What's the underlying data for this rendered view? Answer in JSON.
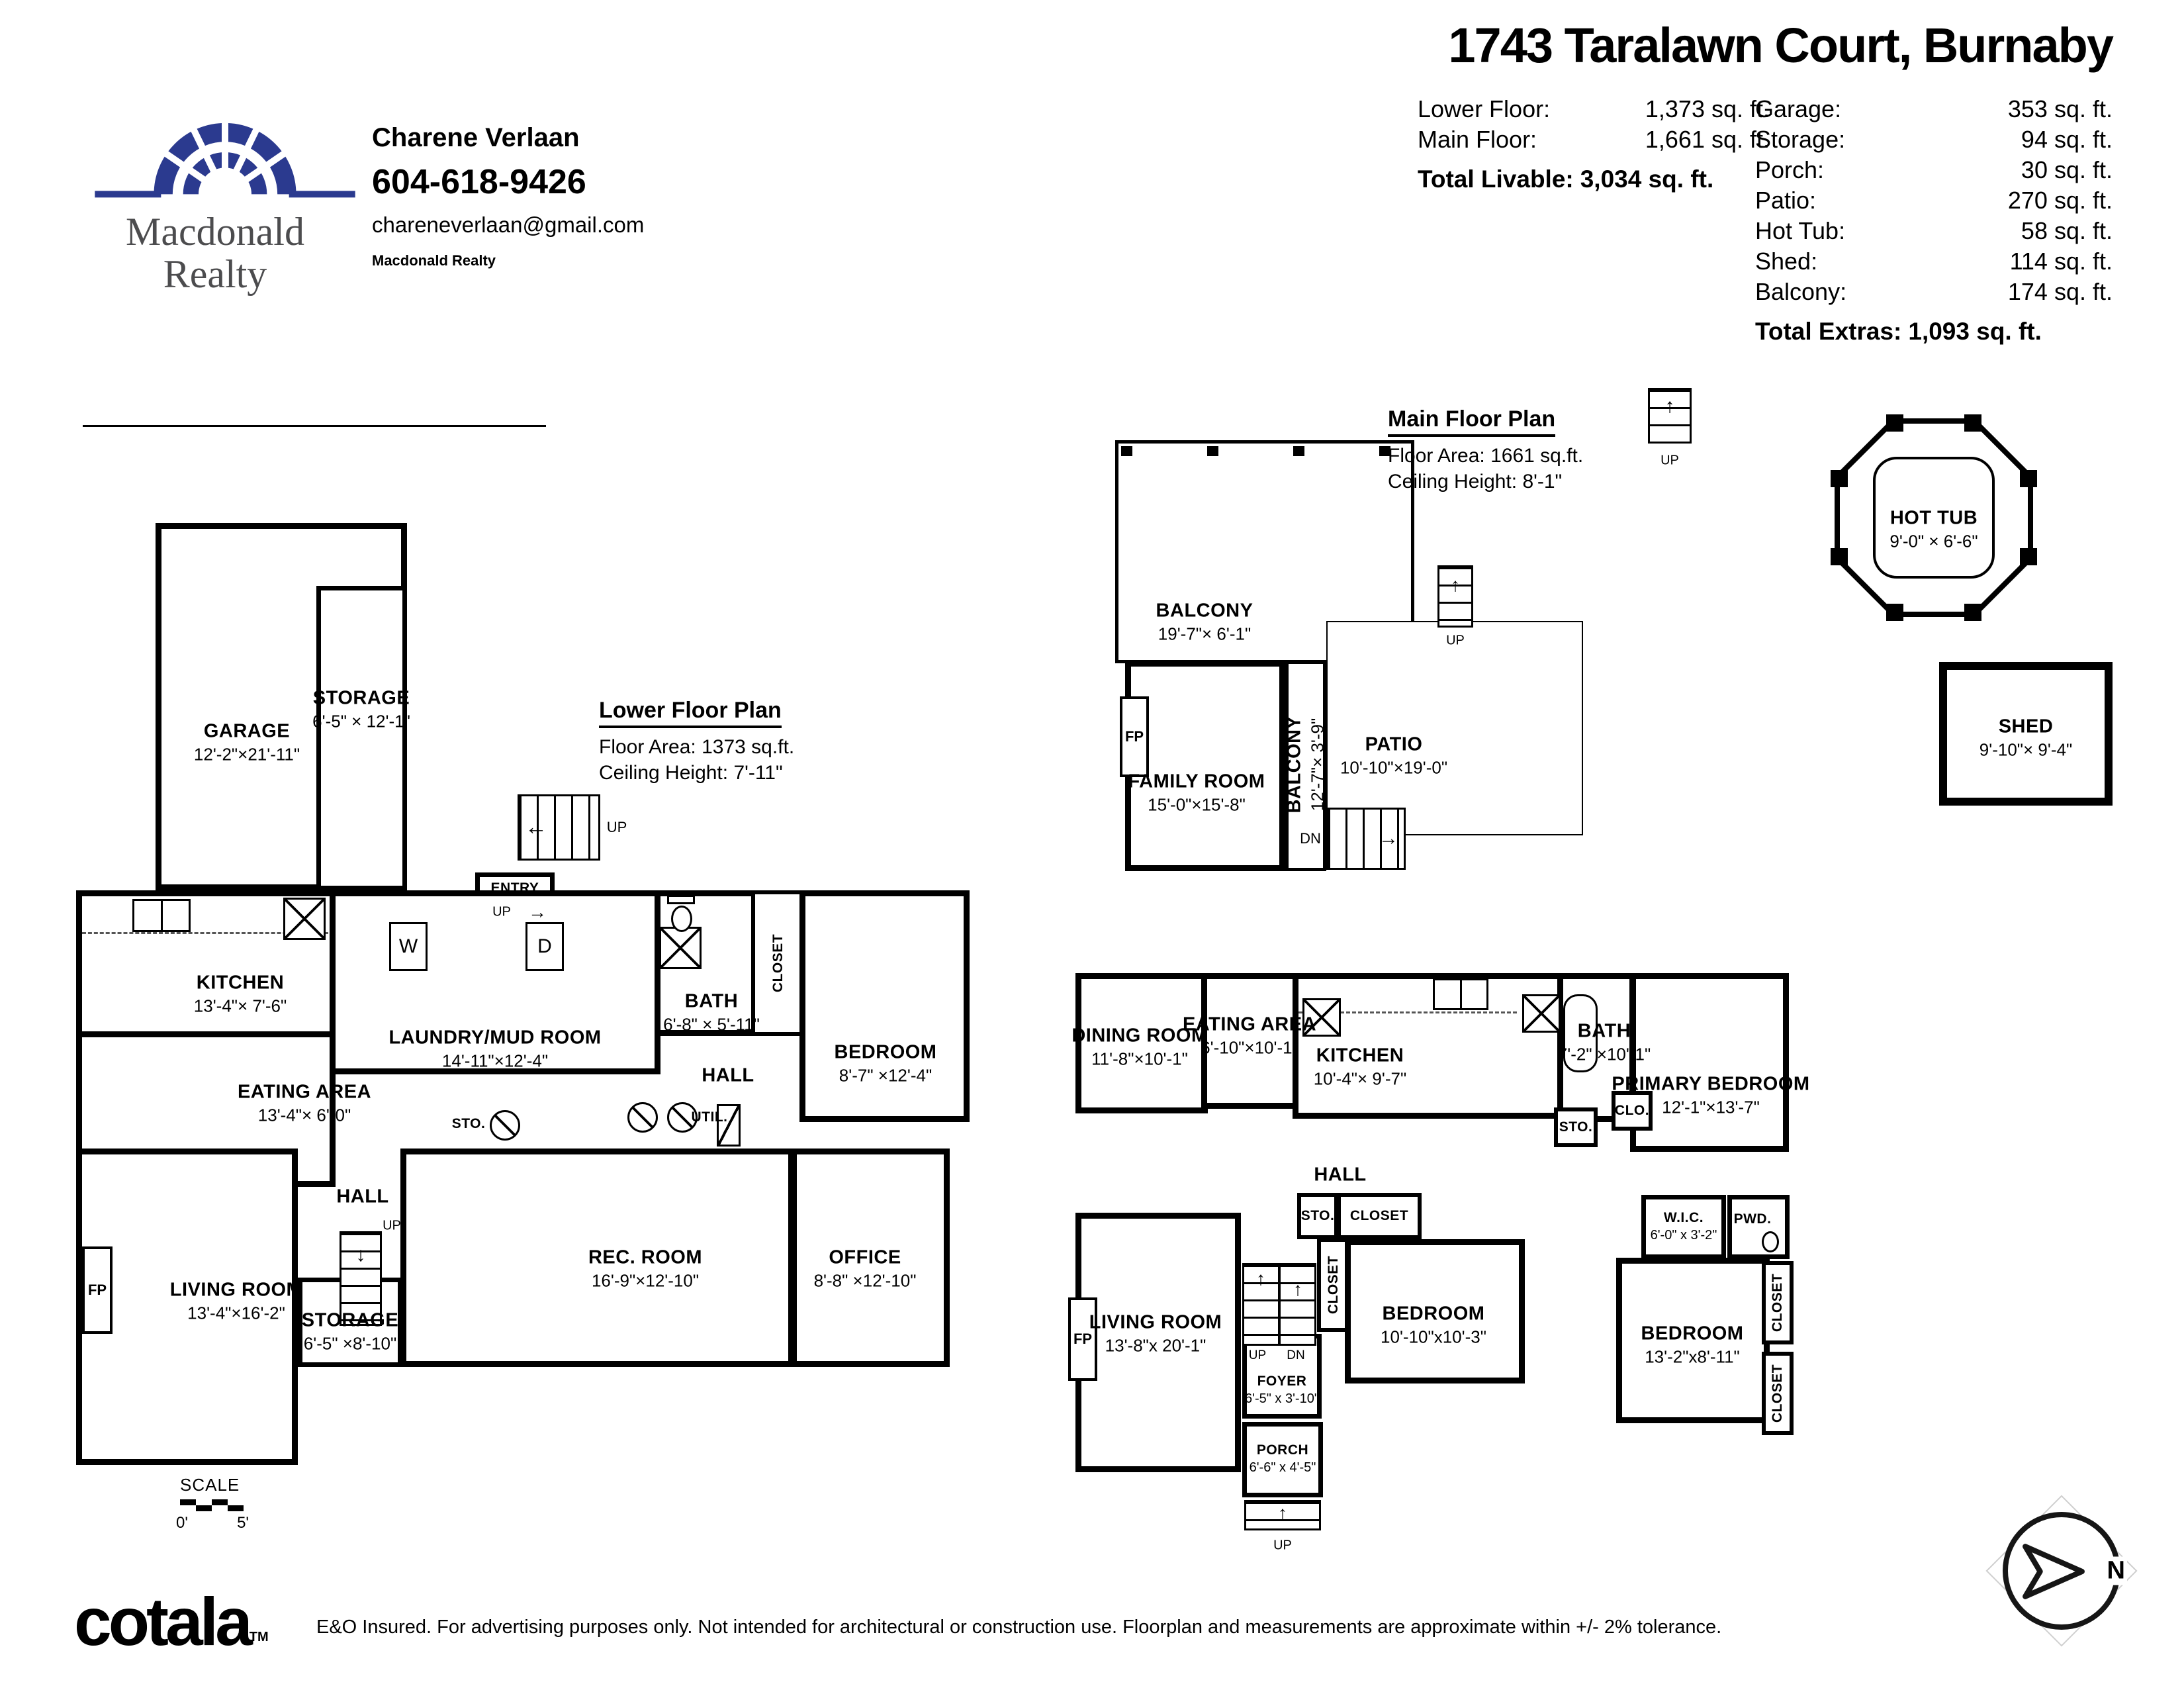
{
  "header": {
    "title": "1743 Taralawn Court, Burnaby",
    "agent": {
      "name": "Charene Verlaan",
      "phone": "604-618-9426",
      "email": "chareneverlaan@gmail.com",
      "brokerage": "Macdonald Realty"
    },
    "logo": {
      "line1": "Macdonald",
      "line2": "Realty"
    },
    "brand_color": "#2b3a8f",
    "stats_left": {
      "rows": [
        {
          "label": "Lower Floor:",
          "value": "1,373 sq. ft."
        },
        {
          "label": "Main Floor:",
          "value": "1,661 sq. ft."
        }
      ],
      "total_label": "Total Livable:",
      "total_value": "3,034 sq. ft."
    },
    "stats_right": {
      "rows": [
        {
          "label": "Garage:",
          "value": "353 sq. ft."
        },
        {
          "label": "Storage:",
          "value": "94 sq. ft."
        },
        {
          "label": "Porch:",
          "value": "30 sq. ft."
        },
        {
          "label": "Patio:",
          "value": "270 sq. ft."
        },
        {
          "label": "Hot Tub:",
          "value": "58 sq. ft."
        },
        {
          "label": "Shed:",
          "value": "114 sq. ft."
        },
        {
          "label": "Balcony:",
          "value": "174 sq. ft."
        }
      ],
      "total_label": "Total Extras:",
      "total_value": "1,093 sq. ft."
    }
  },
  "icons": {
    "arrow_up": "↑",
    "arrow_down": "↓",
    "arrow_left": "←",
    "arrow_right": "→"
  },
  "lower": {
    "plan_title": "Lower Floor Plan",
    "floor_area": "Floor Area: 1373 sq.ft.",
    "ceiling": "Ceiling Height: 7'-11\"",
    "rooms": {
      "garage": {
        "name": "GARAGE",
        "dims": "12'-2\"×21'-11\""
      },
      "storage_upper": {
        "name": "STORAGE",
        "dims": "6'-5\" × 12'-1\""
      },
      "entry": {
        "name": "ENTRY"
      },
      "kitchen": {
        "name": "KITCHEN",
        "dims": "13'-4\"× 7'-6\""
      },
      "eating": {
        "name": "EATING AREA",
        "dims": "13'-4\"× 6'-0\""
      },
      "laundry": {
        "name": "LAUNDRY/MUD ROOM",
        "dims": "14'-11\"×12'-4\""
      },
      "bath": {
        "name": "BATH",
        "dims": "6'-8\" × 5'-11\""
      },
      "closet": {
        "name": "CLOSET"
      },
      "bedroom": {
        "name": "BEDROOM",
        "dims": "8'-7\" ×12'-4\""
      },
      "hall_upper": {
        "name": "HALL"
      },
      "util": {
        "name": "UTIL."
      },
      "sto": {
        "name": "STO."
      },
      "hall_lower": {
        "name": "HALL"
      },
      "living": {
        "name": "LIVING ROOM",
        "dims": "13'-4\"×16'-2\""
      },
      "storage_lower": {
        "name": "STORAGE",
        "dims": "6'-5\" ×8'-10\""
      },
      "rec": {
        "name": "REC. ROOM",
        "dims": "16'-9\"×12'-10\""
      },
      "office": {
        "name": "OFFICE",
        "dims": "8'-8\" ×12'-10\""
      }
    },
    "labels": {
      "up1": "UP",
      "up2": "UP",
      "up3": "UP",
      "w": "W",
      "d": "D",
      "fp": "FP"
    },
    "scale": {
      "title": "SCALE",
      "start": "0'",
      "end": "5'"
    }
  },
  "main": {
    "plan_title": "Main Floor Plan",
    "floor_area": "Floor Area: 1661 sq.ft.",
    "ceiling": "Ceiling Height: 8'-1\"",
    "rooms": {
      "balcony_top": {
        "name": "BALCONY",
        "dims": "19'-7\"× 6'-1\""
      },
      "family": {
        "name": "FAMILY ROOM",
        "dims": "15'-0\"×15'-8\""
      },
      "balcony_side": {
        "name": "BALCONY",
        "dims": "12'-7\"× 3'-9\""
      },
      "patio": {
        "name": "PATIO",
        "dims": "10'-10\"×19'-0\""
      },
      "hot_tub": {
        "name": "HOT TUB",
        "dims": "9'-0\" × 6'-6\""
      },
      "shed": {
        "name": "SHED",
        "dims": "9'-10\"× 9'-4\""
      },
      "dining": {
        "name": "DINING ROOM",
        "dims": "11'-8\"×10'-1\""
      },
      "eating": {
        "name": "EATING AREA",
        "dims": "6'-10\"×10'-1\""
      },
      "kitchen": {
        "name": "KITCHEN",
        "dims": "10'-4\"× 9'-7\""
      },
      "bath": {
        "name": "BATH",
        "dims": "7'-2\" ×10'-1\""
      },
      "primary": {
        "name": "PRIMARY BEDROOM",
        "dims": "12'-1\"×13'-7\""
      },
      "hall": {
        "name": "HALL"
      },
      "sto_hall": {
        "name": "STO."
      },
      "closet_hall": {
        "name": "CLOSET"
      },
      "closet_stair": {
        "name": "CLOSET"
      },
      "clo": {
        "name": "CLO."
      },
      "sto_bath": {
        "name": "STO."
      },
      "wic": {
        "name": "W.I.C.",
        "dims": "6'-0\" x 3'-2\""
      },
      "pwd": {
        "name": "PWD."
      },
      "living": {
        "name": "LIVING ROOM",
        "dims": "13'-8\"x 20'-1\""
      },
      "foyer": {
        "name": "FOYER",
        "dims": "6'-5\" x 3'-10\""
      },
      "porch": {
        "name": "PORCH",
        "dims": "6'-6\" x 4'-5\""
      },
      "bedroom1": {
        "name": "BEDROOM",
        "dims": "10'-10\"x10'-3\""
      },
      "bedroom2": {
        "name": "BEDROOM",
        "dims": "13'-2\"x8'-11\""
      },
      "closet_r1": {
        "name": "CLOSET"
      },
      "closet_r2": {
        "name": "CLOSET"
      }
    },
    "labels": {
      "up_top": "UP",
      "up_patio": "UP",
      "dn_patio": "DN",
      "up_foyer": "UP",
      "dn_foyer": "DN",
      "up_porch": "UP",
      "fp_family": "FP",
      "fp_living": "FP"
    }
  },
  "footer": {
    "logo": "cotala",
    "logo_tm": "TM",
    "disclaimer": "E&O Insured. For advertising purposes only. Not intended for architectural or construction use. Floorplan and measurements are approximate within +/- 2% tolerance.",
    "compass_n": "N"
  }
}
